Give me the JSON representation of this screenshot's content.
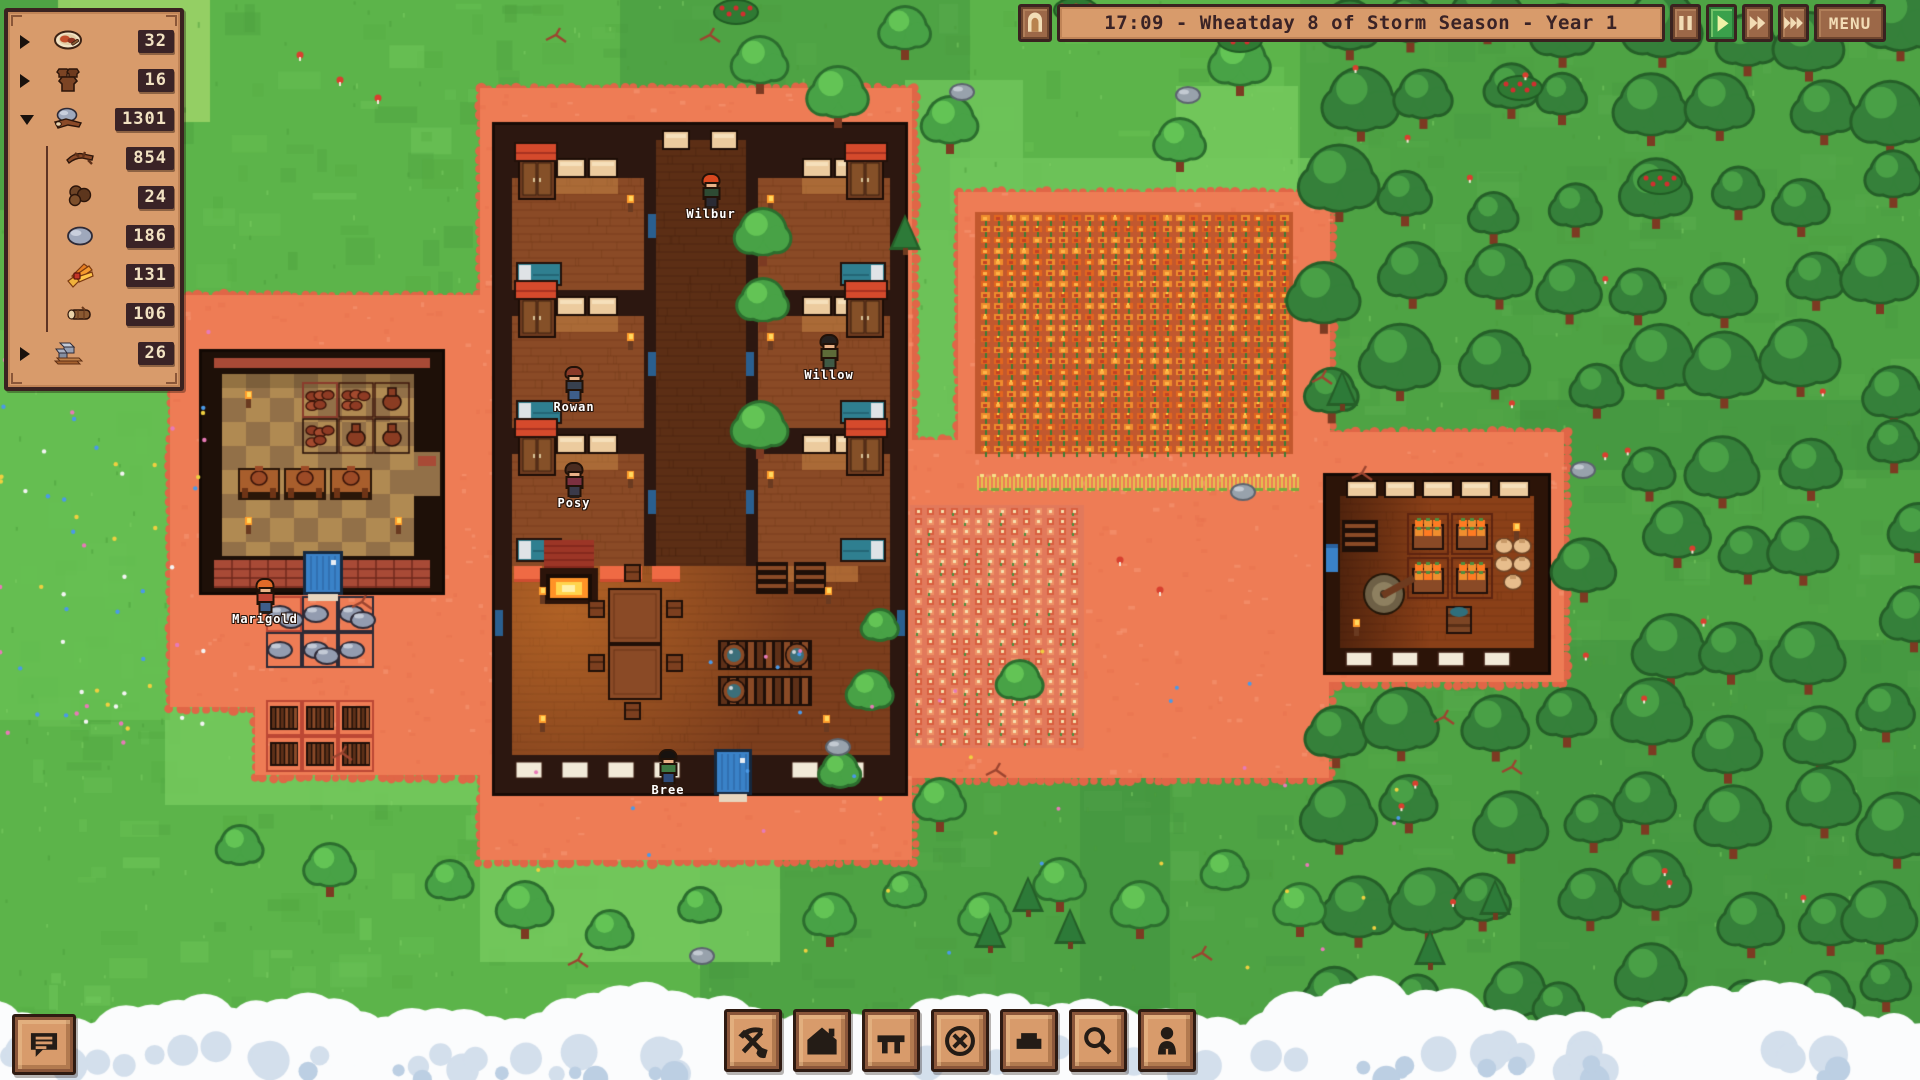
{
  "colors": {
    "ui_panel_bg": "#d89b6b",
    "ui_panel_border": "#3a2220",
    "ui_badge_bg": "#3a2326",
    "ui_badge_text": "#f2e2c2",
    "ui_text_dark": "#3a2326",
    "ui_glyph_cream": "#f2dcb5",
    "ui_glyph_dark": "#241c16",
    "play_active_green": "#3aa14b",
    "grass_green": "#5cb44a",
    "dirt_terracotta": "#ee7c55",
    "door_blue": "#3a82c8",
    "bed_teal": "#2f7f90",
    "accent_red": "#d54a2c"
  },
  "resource_panel": {
    "rows": [
      {
        "id": "meals",
        "icon": "meal-plate-icon",
        "caret": "right",
        "count": "32"
      },
      {
        "id": "pots",
        "icon": "pots-icon",
        "caret": "right",
        "count": "16"
      },
      {
        "id": "materials",
        "icon": "materials-pile-icon",
        "caret": "down",
        "count": "1301"
      },
      {
        "id": "sticks",
        "icon": "sticks-icon",
        "child": true,
        "count": "854"
      },
      {
        "id": "peat",
        "icon": "peat-clumps-icon",
        "child": true,
        "count": "24"
      },
      {
        "id": "stone",
        "icon": "stone-icon",
        "child": true,
        "count": "186"
      },
      {
        "id": "kindling",
        "icon": "kindling-bundle-icon",
        "child": true,
        "count": "131"
      },
      {
        "id": "logs",
        "icon": "log-icon",
        "child": true,
        "count": "106"
      },
      {
        "id": "blocks",
        "icon": "blocks-planks-icon",
        "caret": "right",
        "count": "26"
      }
    ]
  },
  "time_bar": {
    "home_icon": "arch-door-icon",
    "text": "17:09 - Wheatday 8 of Storm Season - Year 1",
    "buttons": [
      {
        "id": "pause",
        "icon": "pause-icon",
        "active": false
      },
      {
        "id": "play",
        "icon": "play-icon",
        "active": true
      },
      {
        "id": "fast-forward",
        "icon": "fast-forward-icon",
        "active": false
      },
      {
        "id": "fastest-forward",
        "icon": "fastest-forward-icon",
        "active": false
      }
    ],
    "menu_label": "MENU"
  },
  "toolbar": {
    "buttons": [
      {
        "id": "mine",
        "icon": "pickaxe-shovel-icon"
      },
      {
        "id": "build",
        "icon": "house-icon"
      },
      {
        "id": "furniture",
        "icon": "table-icon"
      },
      {
        "id": "cancel",
        "icon": "cancel-circle-icon"
      },
      {
        "id": "terrain",
        "icon": "block-icon"
      },
      {
        "id": "inspect",
        "icon": "magnifier-icon"
      },
      {
        "id": "villagers",
        "icon": "villager-icon"
      }
    ]
  },
  "notifications_button": {
    "icon": "message-log-icon"
  },
  "characters": [
    {
      "name": "Wilbur",
      "x": 711,
      "y": 213,
      "hair": "#d8481f",
      "shirt": "#2e4b33",
      "pants": "#2b2b34"
    },
    {
      "name": "Willow",
      "x": 829,
      "y": 374,
      "hair": "#24201e",
      "shirt": "#5d6b38",
      "pants": "#3f5a45"
    },
    {
      "name": "Rowan",
      "x": 574,
      "y": 406,
      "hair": "#8a3a28",
      "shirt": "#37404f",
      "pants": "#3e5e8a"
    },
    {
      "name": "Posy",
      "x": 574,
      "y": 502,
      "hair": "#4a2c20",
      "shirt": "#7c3040",
      "pants": "#3a3a4a"
    },
    {
      "name": "Bree",
      "x": 668,
      "y": 789,
      "hair": "#17120f",
      "shirt": "#3f7a44",
      "pants": "#2e4b7a"
    },
    {
      "name": "Marigold",
      "x": 265,
      "y": 618,
      "hair": "#e06a28",
      "shirt": "#c04434",
      "pants": "#3e5e8a"
    }
  ]
}
